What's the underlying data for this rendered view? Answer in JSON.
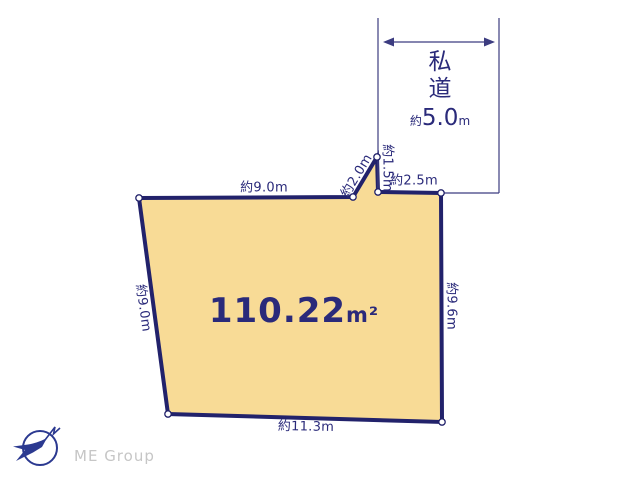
{
  "page": {
    "background": "#ffffff"
  },
  "colors": {
    "page_bg": "#ffffff",
    "line": "#22226b",
    "thin_line": "#3c3c80",
    "text": "#2a2a7a",
    "parcel_fill": "#f8db96",
    "vertex_fill": "#ffffff",
    "logo_blue": "#2b3990",
    "logo_gray": "#c6c6c6"
  },
  "parcel": {
    "area_value": "110.22",
    "area_unit": "m²"
  },
  "road": {
    "name_line1": "私",
    "name_line2": "道",
    "width_prefix": "約",
    "width_value": "5.0",
    "width_unit": "m"
  },
  "geometry": {
    "parcel_vertices": [
      [
        139,
        198
      ],
      [
        353,
        197
      ],
      [
        377,
        157
      ],
      [
        378,
        192
      ],
      [
        441,
        193
      ],
      [
        442,
        422
      ],
      [
        168,
        414
      ]
    ],
    "road_lines": [
      [
        [
          378,
          18
        ],
        [
          378,
          190
        ]
      ],
      [
        [
          499,
          18
        ],
        [
          499,
          193
        ]
      ],
      [
        [
          441,
          193
        ],
        [
          499,
          193
        ]
      ]
    ],
    "road_arrow": [
      [
        383,
        42
      ],
      [
        495,
        42
      ]
    ]
  },
  "dimensions": [
    {
      "id": "top-edge",
      "label": "約9.0m",
      "x": 264,
      "y": 188,
      "rotate": 0
    },
    {
      "id": "diagonal-edge",
      "label": "約2.0m",
      "x": 357,
      "y": 176,
      "rotate": -59
    },
    {
      "id": "notch-edge",
      "label": "約1.5m",
      "x": 387,
      "y": 168,
      "rotate": 90
    },
    {
      "id": "frontage-edge",
      "label": "約2.5m",
      "x": 414,
      "y": 181,
      "rotate": 0
    },
    {
      "id": "right-edge",
      "label": "約9.6m",
      "x": 451,
      "y": 306,
      "rotate": 90
    },
    {
      "id": "left-edge",
      "label": "約9.0m",
      "x": 143,
      "y": 308,
      "rotate": 82
    },
    {
      "id": "bottom-edge",
      "label": "約11.3m",
      "x": 306,
      "y": 427,
      "rotate": 1
    }
  ],
  "logo": {
    "text": "ME Group"
  }
}
